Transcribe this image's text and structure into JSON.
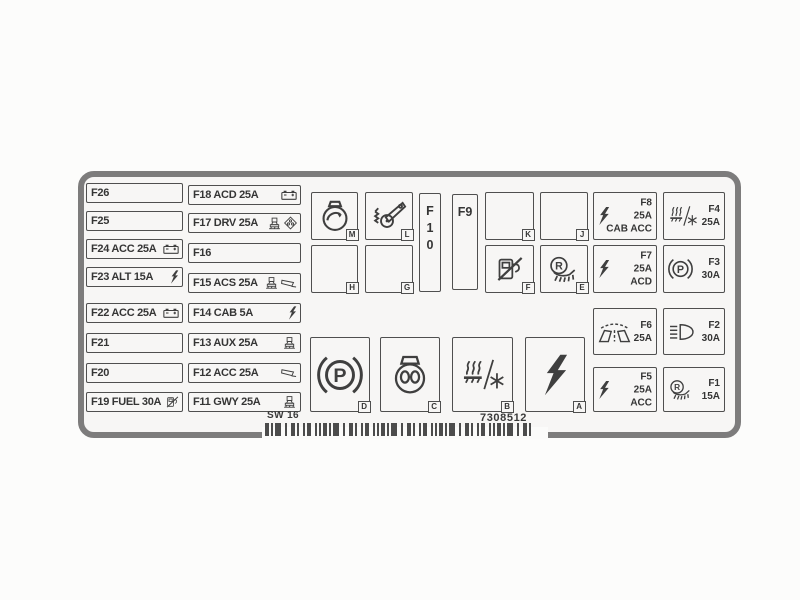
{
  "page": {
    "background": "#fcfcfb"
  },
  "panel": {
    "background": "#f7f6f5",
    "border_color": "#7d7c7c",
    "text_color": "#353535"
  },
  "footer": {
    "code_left": "SW 16",
    "code_right": "7308512"
  },
  "fuse_rows_col1": [
    {
      "id": "F26",
      "label": "F26",
      "icons": []
    },
    {
      "id": "F25",
      "label": "F25",
      "icons": []
    },
    {
      "id": "F24",
      "label": "F24 ACC 25A",
      "icons": [
        "battery-icon"
      ]
    },
    {
      "id": "F23",
      "label": "F23 ALT 15A",
      "icons": [
        "lightning-bolt-icon"
      ]
    },
    {
      "id": "F22",
      "label": "F22 ACC 25A",
      "icons": [
        "battery-icon"
      ]
    },
    {
      "id": "F21",
      "label": "F21",
      "icons": []
    },
    {
      "id": "F20",
      "label": "F20",
      "icons": []
    },
    {
      "id": "F19",
      "label": "F19 FUEL 30A",
      "icons": [
        "fuel-pump-slash-icon"
      ]
    }
  ],
  "fuse_rows_col2": [
    {
      "id": "F18",
      "label": "F18 ACD 25A",
      "icons": [
        "battery-icon"
      ]
    },
    {
      "id": "F17",
      "label": "F17 DRV 25A",
      "icons": [
        "seat-pedestal-icon",
        "diff-lock-icon"
      ]
    },
    {
      "id": "F16",
      "label": "F16",
      "icons": []
    },
    {
      "id": "F15",
      "label": "F15 ACS 25A",
      "icons": [
        "seat-pedestal-icon",
        "mirror-icon"
      ]
    },
    {
      "id": "F14",
      "label": "F14 CAB 5A",
      "icons": [
        "lightning-bolt-icon"
      ]
    },
    {
      "id": "F13",
      "label": "F13 AUX 25A",
      "icons": [
        "seat-pedestal-icon"
      ]
    },
    {
      "id": "F12",
      "label": "F12 ACC 25A",
      "icons": [
        "mirror-icon"
      ]
    },
    {
      "id": "F11",
      "label": "F11 GWY 25A",
      "icons": [
        "seat-pedestal-icon"
      ]
    }
  ],
  "relay_boxes": [
    {
      "letter": "M",
      "icon": "alternator-icon"
    },
    {
      "letter": "L",
      "icon": "pedal-lever-icon"
    },
    {
      "letter": "K",
      "icon": null
    },
    {
      "letter": "J",
      "icon": null
    },
    {
      "letter": "H",
      "icon": null
    },
    {
      "letter": "G",
      "icon": null
    },
    {
      "letter": "F",
      "icon": "fuel-pump-slash-icon"
    },
    {
      "letter": "E",
      "icon": "work-lamp-r-icon"
    }
  ],
  "vertical_fuses": [
    {
      "id": "F10",
      "label": "F10"
    },
    {
      "id": "F9",
      "label": "F9"
    }
  ],
  "info_fuses": [
    {
      "id": "F8",
      "lines": [
        "F8",
        "25A",
        "CAB ACC"
      ],
      "icon": "lightning-bolt-icon"
    },
    {
      "id": "F4",
      "lines": [
        "F4",
        "25A"
      ],
      "icon": "heater-ac-icon"
    },
    {
      "id": "F7",
      "lines": [
        "F7",
        "25A",
        "ACD"
      ],
      "icon": "lightning-bolt-icon"
    },
    {
      "id": "F3",
      "lines": [
        "F3",
        "30A"
      ],
      "icon": "park-brake-icon"
    },
    {
      "id": "F6",
      "lines": [
        "F6",
        "25A"
      ],
      "icon": "wiper-icon"
    },
    {
      "id": "F2",
      "lines": [
        "F2",
        "30A"
      ],
      "icon": "headlight-icon"
    },
    {
      "id": "F5",
      "lines": [
        "F5",
        "25A",
        "ACC"
      ],
      "icon": "lightning-bolt-icon"
    },
    {
      "id": "F1",
      "lines": [
        "F1",
        "15A"
      ],
      "icon": "work-lamp-r-icon"
    }
  ],
  "big_relay_boxes": [
    {
      "letter": "D",
      "icon": "park-brake-icon"
    },
    {
      "letter": "C",
      "icon": "horn-icon"
    },
    {
      "letter": "B",
      "icon": "heater-ac-icon"
    },
    {
      "letter": "A",
      "icon": "lightning-bolt-icon"
    }
  ],
  "icons": {
    "battery-icon": "battery",
    "lightning-bolt-icon": "electrical power",
    "fuel-pump-slash-icon": "fuel shut-off",
    "seat-pedestal-icon": "seat / pedestal device",
    "mirror-icon": "mirror",
    "diff-lock-icon": "diff lock diamond",
    "alternator-icon": "alternator",
    "pedal-lever-icon": "pedal lever",
    "park-brake-icon": "parking brake",
    "work-lamp-r-icon": "reverse work lamp",
    "wiper-icon": "windshield wiper",
    "headlight-icon": "headlight",
    "heater-ac-icon": "heater / air conditioning",
    "horn-icon": "horn"
  }
}
